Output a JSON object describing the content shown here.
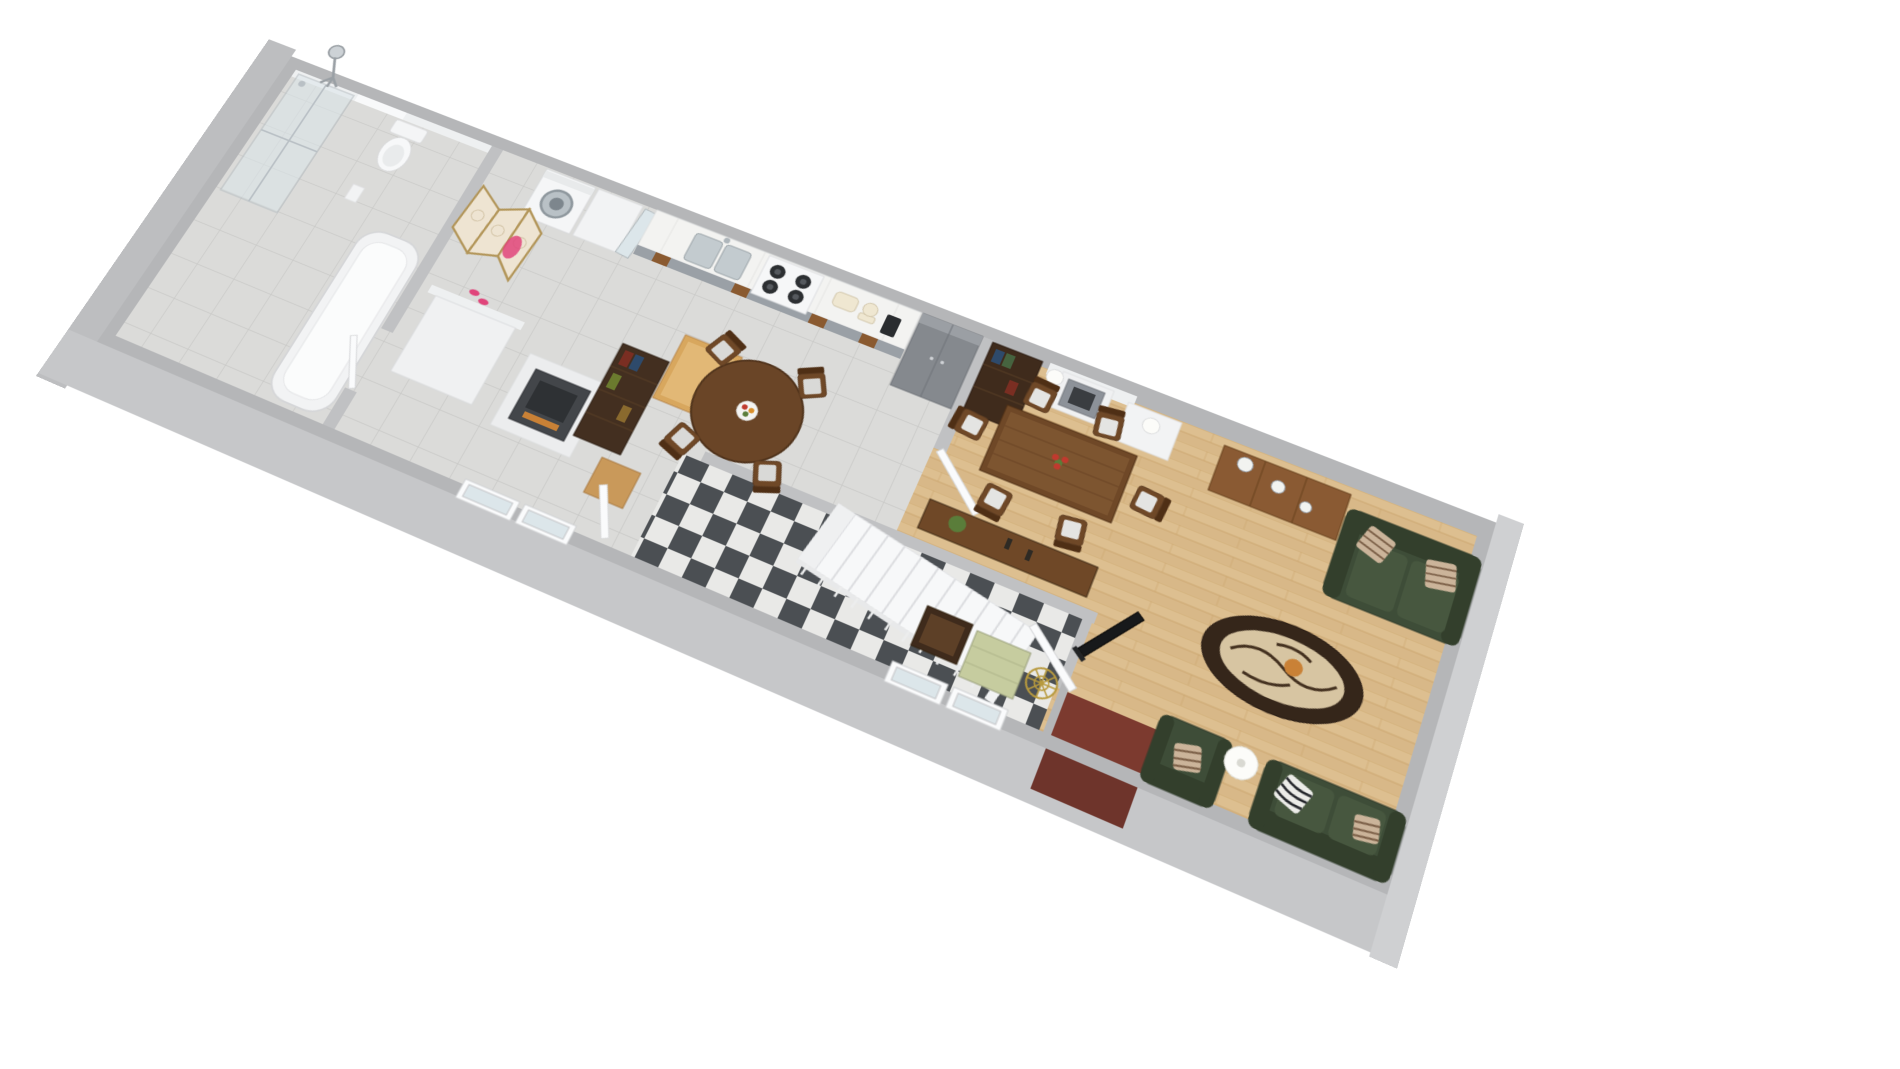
{
  "scene": {
    "type": "3d-floor-plan-render",
    "view": "isometric birds-eye, strip apartment rotated diagonally",
    "rooms": [
      {
        "name": "bathroom",
        "floor": "grey-ceramic-tile"
      },
      {
        "name": "laundry-area",
        "floor": "grey-ceramic-tile"
      },
      {
        "name": "kitchen-dining",
        "floor": "grey-ceramic-tile"
      },
      {
        "name": "hallway",
        "floor": "checkerboard-marble"
      },
      {
        "name": "living-room",
        "floor": "light-oak-plank"
      },
      {
        "name": "entry-porch",
        "floor": "brick-red-tile"
      }
    ],
    "furniture": [
      "shower-enclosure",
      "toilet",
      "bathtub",
      "folding-screen",
      "pink-robe",
      "slippers",
      "washing-machine",
      "white-cabinet",
      "white-wardrobe",
      "leaning-glass-door",
      "kitchen-counter",
      "double-sink",
      "faucet",
      "stove-four-burners",
      "toaster",
      "food-mixer",
      "coffee-machine",
      "tall-grey-cabinet",
      "dark-bookcase-kitchen",
      "wooden-work-table",
      "wooden-crate",
      "dark-fireplace",
      "round-dining-table",
      "fruit-bowl",
      "kitchen-chairs-4",
      "white-staircase",
      "stair-railing",
      "console-table",
      "potted-plant",
      "candlesticks",
      "dark-bookcase-living",
      "white-fireplace",
      "mantel-lamps-2",
      "rect-dining-table",
      "flower-vase-red",
      "dining-chairs-6",
      "sideboard",
      "vases-3",
      "green-sofa-top",
      "green-sofa-bottom",
      "green-armchair",
      "striped-pillows",
      "zebra-pillow",
      "oval-coffee-table",
      "floor-lamp-shade",
      "tv-flatscreen",
      "brass-coat-stand",
      "sage-console-table",
      "dark-side-table",
      "front-door",
      "interior-doors",
      "french-windows",
      "chrome-studio-lamp"
    ]
  },
  "colors": {
    "background": "#ffffff",
    "wall_gray": "#b5b6b8",
    "wall_face": "#c6c7c9",
    "wall_face_left": "#bdbec0",
    "wall_face_right": "#cfd0d2",
    "wall_white": "#eef0f1",
    "inner_wall": "#c0c1c3",
    "tile_base": "#dbdbd9",
    "tile_grid": "#c8c8c6",
    "wood_base": "#d8b888",
    "wood_light": "#e3c79a",
    "wood_dark": "#c7a168",
    "check_dark": "#4b4f53",
    "check_light": "#e9e9e7",
    "porch_red": "#7c3a2f",
    "porch_red_dark": "#6e342b",
    "sofa_green": "#3e4d38",
    "sofa_green_dark": "#333f2c",
    "cushion_green": "#47573f",
    "pillow_beige": "#cbb49a",
    "pillow_stripe": "#7b5f47",
    "walnut": "#6f4827",
    "walnut_dark": "#4f2f15",
    "walnut_top": "#7d5530",
    "espresso": "#432f20",
    "espresso2": "#3f2b1c",
    "sideboard_wood": "#8a5a33",
    "oak": "#d8a75e",
    "crate_wood": "#c9995a",
    "round_table": "#6a4527",
    "white_goods": "#f5f6f7",
    "steel": "#9aa0a6",
    "chrome": "#b9c0c5",
    "glass": "#dce6ea",
    "brass": "#b89a3e",
    "sage": "#c6cc9f",
    "fire_dark": "#43464a",
    "amber": "#c98136",
    "lamp_white": "#fcfcf9",
    "flower_red": "#c03a2e",
    "plant_green": "#5a7d3a",
    "pink": "#e0457b",
    "screen_cream": "#eee4d2",
    "screen_gold": "#b29558",
    "tv_black": "#17191b",
    "coffee_ring": "#35261a",
    "coffee_glass": "#d7c5a2",
    "stair_white": "#f7f8f9",
    "door_white": "#fafbfc",
    "seat_gray": "#d9d9d7",
    "cushion_pale": "#e4e4e2",
    "counter_top": "#f3f3f1",
    "insert_brown": "#8a5a30",
    "grey_unit": "#85898e",
    "vase_white": "#f2f3f0"
  }
}
